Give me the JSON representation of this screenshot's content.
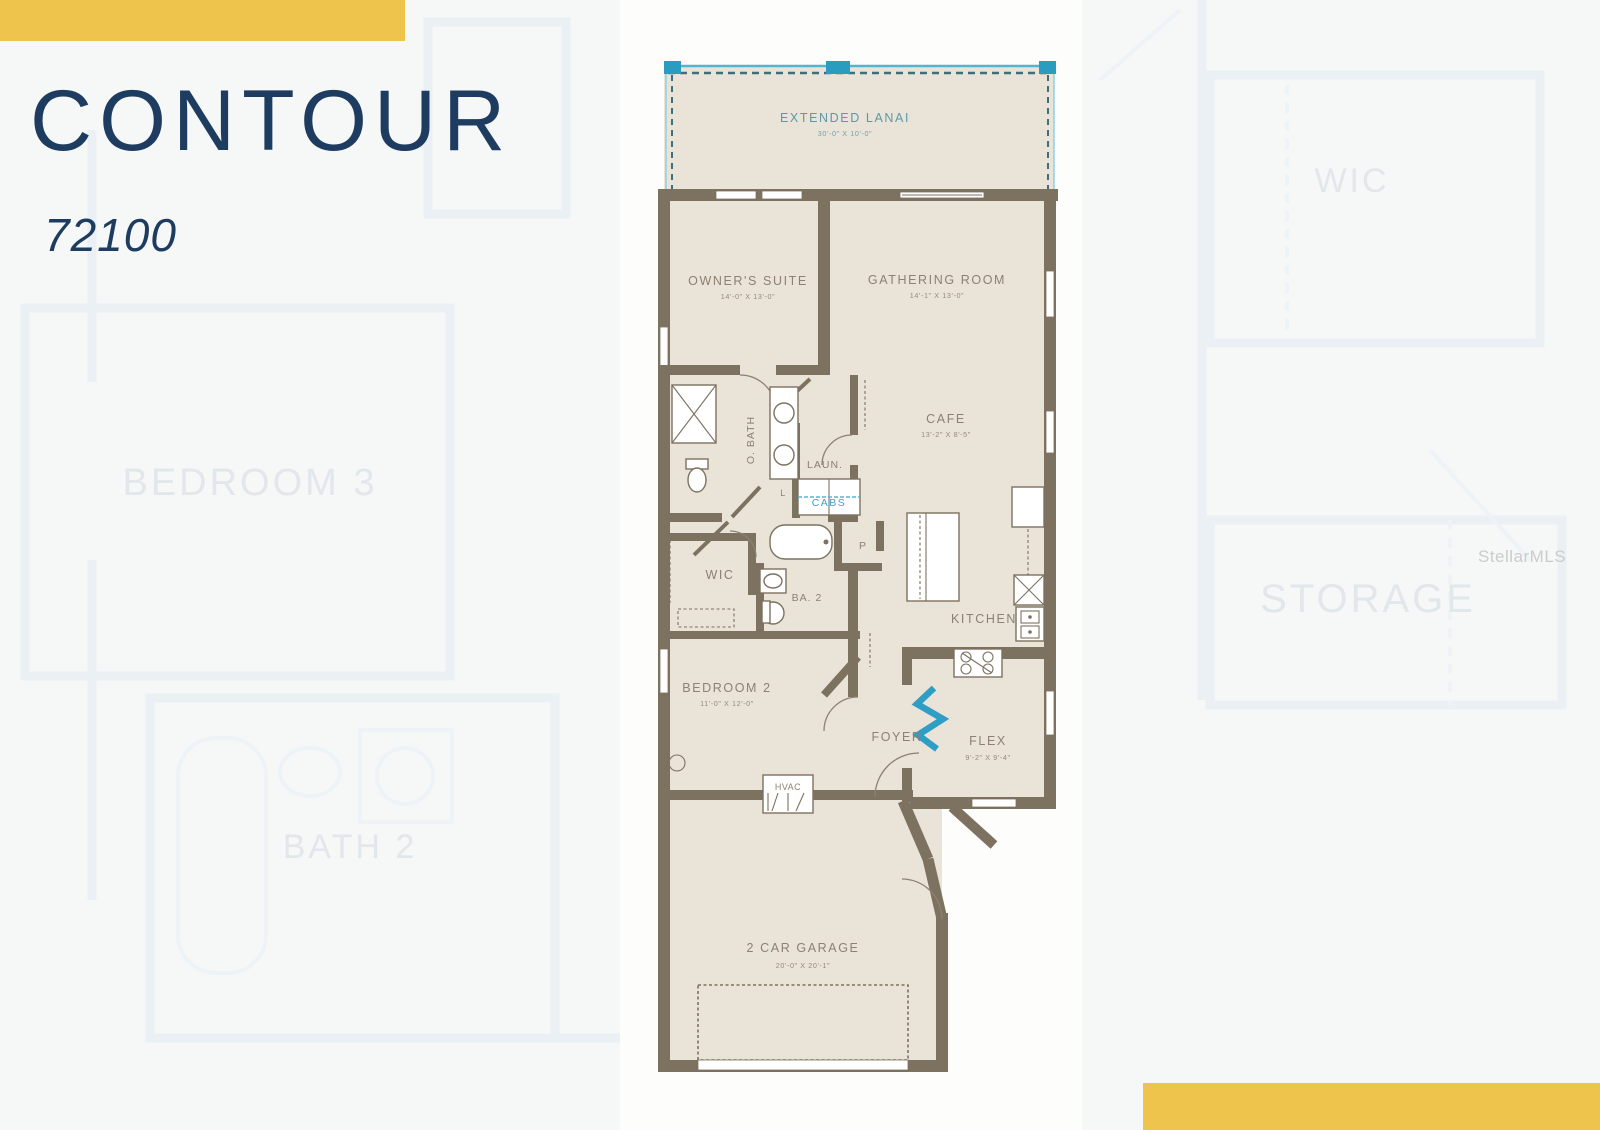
{
  "header": {
    "title": "CONTOUR",
    "model_number": "72100"
  },
  "watermark": "StellarMLS",
  "colors": {
    "accent_yellow": "#eec44d",
    "navy": "#1e3c60",
    "wall_brown": "#7d7160",
    "room_beige": "#e9e4d7",
    "lanai_teal": "#2a9cc0",
    "label_taupe": "#8c8172",
    "page_bg": "#f6f7f7"
  },
  "floorplan": {
    "rooms": {
      "lanai": {
        "label": "EXTENDED LANAI",
        "dims": "30'-0\" X 10'-0\""
      },
      "owners": {
        "label": "OWNER'S SUITE",
        "dims": "14'-0\" X 13'-0\""
      },
      "gathering": {
        "label": "GATHERING ROOM",
        "dims": "14'-1\" X 13'-0\""
      },
      "cafe": {
        "label": "CAFE",
        "dims": "13'-2\" X 8'-5\""
      },
      "obath": {
        "label": "O. BATH"
      },
      "laundry": {
        "label": "LAUN."
      },
      "cabs": {
        "label": "CABS"
      },
      "linen": {
        "label": "L"
      },
      "pantry": {
        "label": "P"
      },
      "wic": {
        "label": "WIC"
      },
      "bath2": {
        "label": "BA. 2"
      },
      "kitchen": {
        "label": "KITCHEN"
      },
      "bedroom2": {
        "label": "BEDROOM 2",
        "dims": "11'-0\" X 12'-0\""
      },
      "foyer": {
        "label": "FOYER"
      },
      "flex": {
        "label": "FLEX",
        "dims": "9'-2\" X 9'-4\""
      },
      "hvac": {
        "label": "HVAC"
      },
      "garage": {
        "label": "2 CAR GARAGE",
        "dims": "20'-0\" X 20'-1\""
      }
    },
    "background_rooms": {
      "bedroom3": {
        "label": "BEDROOM 3"
      },
      "wic": {
        "label": "WIC"
      },
      "storage": {
        "label": "STORAGE"
      },
      "bath2": {
        "label": "BATH 2"
      }
    }
  }
}
